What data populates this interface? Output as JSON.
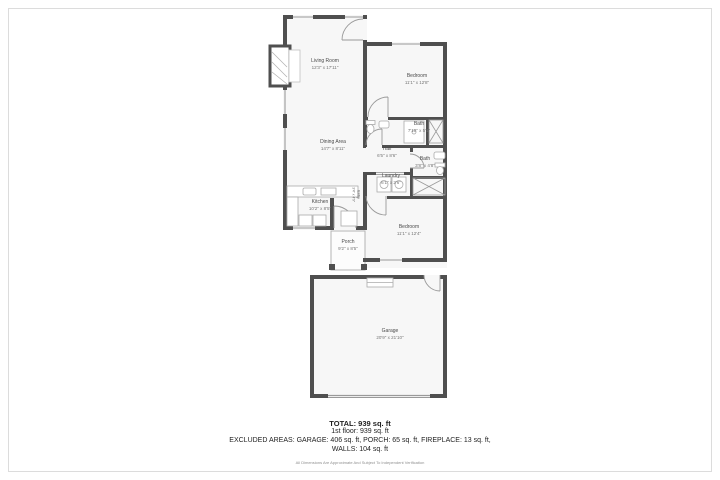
{
  "floor_plan": {
    "colors": {
      "wall": "#4f4f4f",
      "floor": "#f7f7f7",
      "thin_line": "#9a9a9a",
      "frame_border": "#dcdcdc",
      "background": "#ffffff"
    },
    "rooms": {
      "living": {
        "name": "Living Room",
        "dims": "12'3\" x 17'11\""
      },
      "bedroom1": {
        "name": "Bedroom",
        "dims": "11'1\" x 12'8\""
      },
      "bath1": {
        "name": "Bath",
        "dims": "7'10\" x 5'1\""
      },
      "hall": {
        "name": "Hall",
        "dims": "6'5\" x 8'6\""
      },
      "laundry": {
        "name": "Laundry",
        "dims": "6'1\" x 2'6\""
      },
      "bath2": {
        "name": "Bath",
        "dims": "3'8\" x 4'8\""
      },
      "dining": {
        "name": "Dining Area",
        "dims": "14'7\" x 8'11\""
      },
      "kitchen": {
        "name": "Kitchen",
        "dims": "10'2\" x 8'5\""
      },
      "entry": {
        "name": "Entry",
        "dims": "3'4\" x 4'9\""
      },
      "bedroom2": {
        "name": "Bedroom",
        "dims": "11'1\" x 12'4\""
      },
      "porch": {
        "name": "Porch",
        "dims": "9'2\" x 8'5\""
      },
      "garage": {
        "name": "Garage",
        "dims": "20'9\" x 21'10\""
      }
    },
    "summary": {
      "total": "TOTAL: 939 sq. ft",
      "first_floor": "1st floor: 939 sq. ft",
      "excluded_line1": "EXCLUDED AREAS: GARAGE: 406 sq. ft, PORCH: 65 sq. ft, FIREPLACE: 13 sq. ft,",
      "excluded_line2": "WALLS: 104 sq. ft",
      "disclaimer": "All Dimensions Are Approximate And Subject To Independent Verification"
    }
  }
}
